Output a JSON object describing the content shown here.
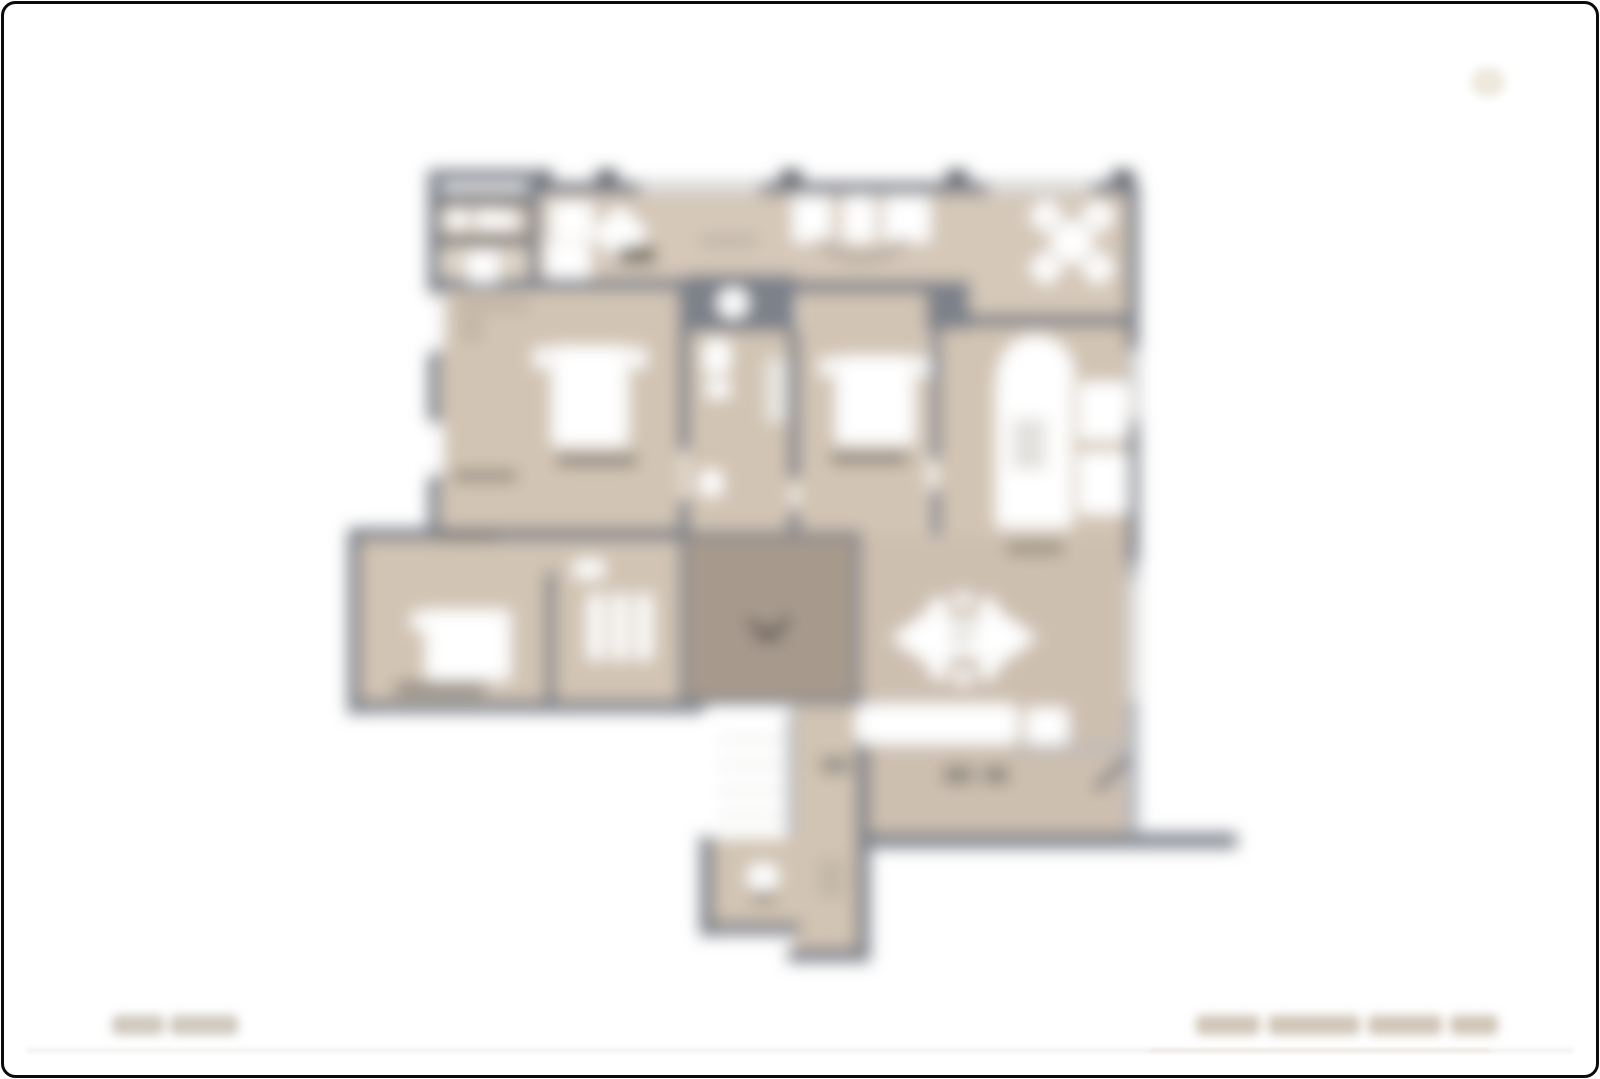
{
  "page": {
    "background": "#ffffff",
    "frame_color": "#0b0b0b",
    "kind": "blurred apartment floor plan sheet"
  },
  "palette": {
    "page_bg": "#ffffff",
    "wall": "#7d818a",
    "wall_dark": "#5d6168",
    "wall_light": "#b5b8be",
    "floor": "#d2c4b4",
    "floor_kitchen": "#d5c8b9",
    "floor_dark": "#cdbfb0",
    "floor_light": "#ded4c8",
    "core": "#a79a8d",
    "white": "#ffffff",
    "smudge": "#6e6a64",
    "mark": "#4e4a44",
    "beige_mid": "#c2b4a4",
    "rule": "#edeae6",
    "rule_dark": "#e2dbd1",
    "footer_blur": "#ccc5b9",
    "watermark": "#eee8dd"
  },
  "footer": {
    "left_text_visible": true,
    "right_text_visible": true,
    "text_legible": false
  },
  "floorplan": {
    "blur_radius_px": 8,
    "legible_labels": false,
    "elements": [
      "balcony",
      "kitchen-strip",
      "bedroom-1",
      "bathroom",
      "bedroom-2",
      "living-room",
      "bedroom-3",
      "closet",
      "stair-core",
      "corridor",
      "utility-room",
      "dining-table",
      "beds",
      "counter",
      "double-arrow-emblem"
    ]
  }
}
